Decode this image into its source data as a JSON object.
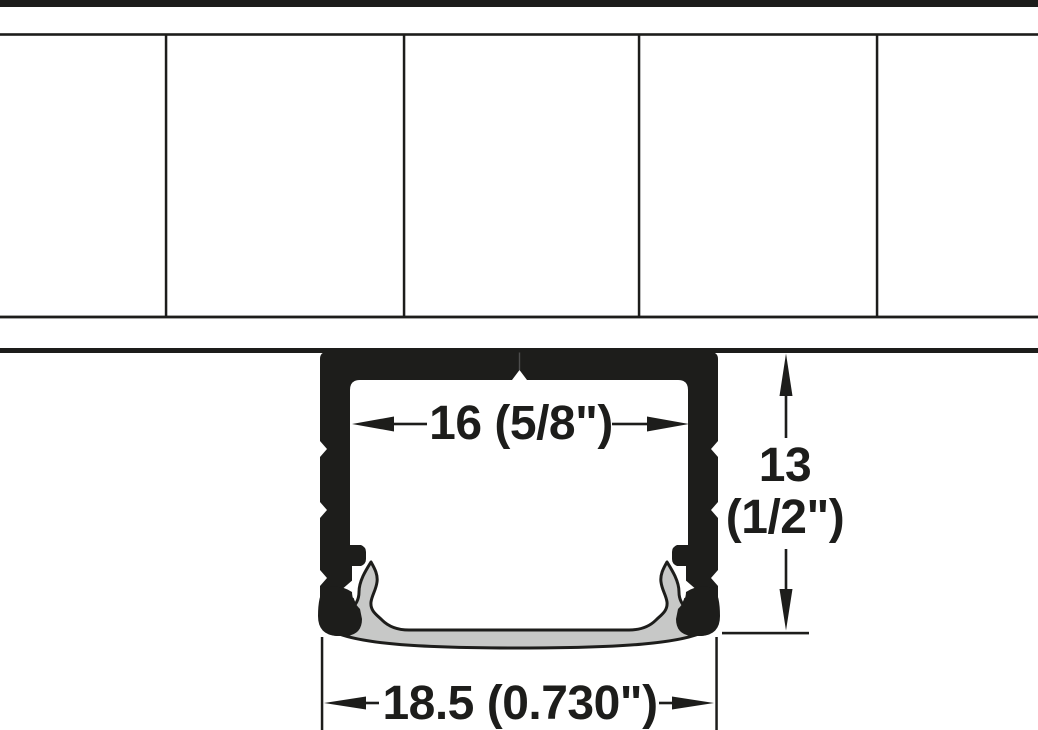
{
  "diagram": {
    "type": "technical-drawing",
    "subject": "recessed-aluminum-profile-cross-section-with-diffuser",
    "dimensions": {
      "inner_width": {
        "label": "16 (5/8\")"
      },
      "height": {
        "line1": "13",
        "line2": "(1/2\")"
      },
      "overall_width": {
        "label": "18.5 (0.730\")"
      }
    },
    "colors": {
      "ink": "#1d1d1b",
      "diffuser_gray": "#c7c8c7",
      "seam_gray": "#4d4d4d",
      "background": "#ffffff"
    }
  }
}
